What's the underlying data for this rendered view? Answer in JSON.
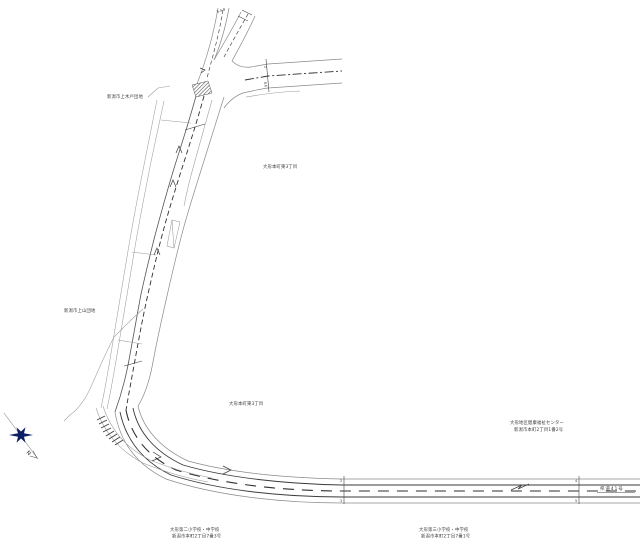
{
  "drawing": {
    "type": "road-plan-map",
    "background": "#ffffff",
    "colors": {
      "road_edge": "#8a8a8a",
      "lane_line": "#3a3a3a",
      "centerline": "#2f2f2f",
      "text": "#3a3a3a",
      "compass_star": "#0c1f63",
      "crosswalk_hatch": "#4a4a4a"
    }
  },
  "labels": {
    "parcel_top": "8-4-9",
    "district_upper_left": "新潟市上木戸団地",
    "district_left": "新潟市上山団地",
    "district_right_upper": "大形本町東3丁目",
    "district_right_lower": "大形本町東3丁目",
    "facility_name": "大形地区健康福祉センター",
    "facility_address": "新潟市本町2丁目1番2号",
    "school_left_name": "大形第二小学校・中学校",
    "school_left_address": "新潟市本町2丁目7番3号",
    "school_right_name": "大形第三小学校・中学校",
    "school_right_address": "新潟市本町2丁目7番1号",
    "route_number": "県道41号",
    "north_mark": "N"
  },
  "stations": {
    "top_tick": {
      "upper": "2",
      "lower": "8.6"
    },
    "bottom_tick_left": {
      "upper": "2",
      "lower": "3"
    },
    "bottom_tick_right": {
      "upper": "4",
      "lower": "5"
    }
  }
}
